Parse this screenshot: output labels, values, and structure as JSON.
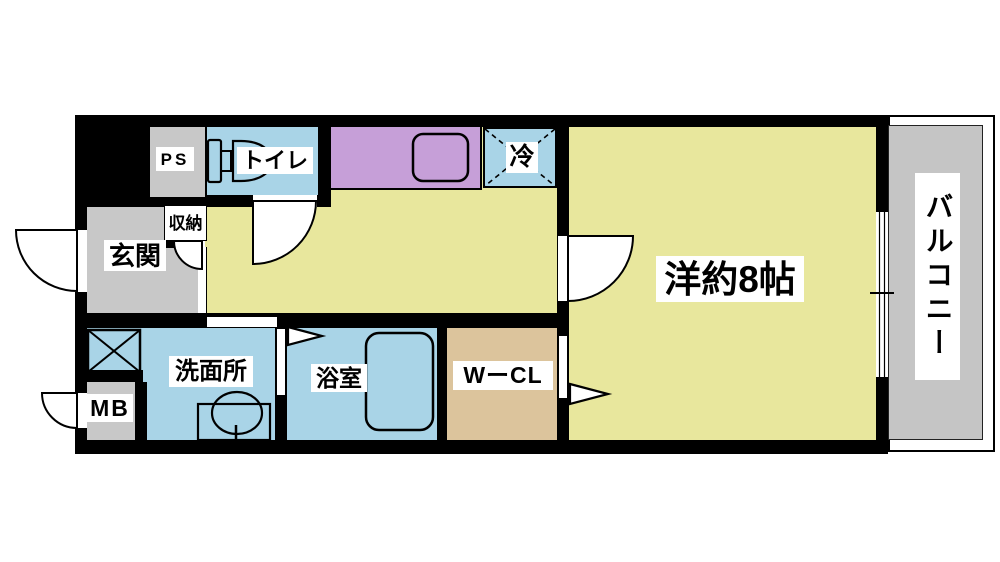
{
  "plan": {
    "labels": {
      "ps": "PS",
      "toilet": "トイレ",
      "fridge": "冷",
      "genkan": "玄関",
      "closet": "収納",
      "washroom": "洗面所",
      "bathroom": "浴室",
      "wcl": "WーCL",
      "main_room": "洋約8帖",
      "mb": "MB",
      "balcony": "バルコニー"
    },
    "colors": {
      "wall": "#000000",
      "floor_yellow": "#e8e79d",
      "wet_blue": "#a9d4e7",
      "kitchen_purple": "#c69fd8",
      "closet_tan": "#dcc49c",
      "gray_fill": "#c8c8c8",
      "balcony_gray": "#c5c5c5"
    }
  }
}
